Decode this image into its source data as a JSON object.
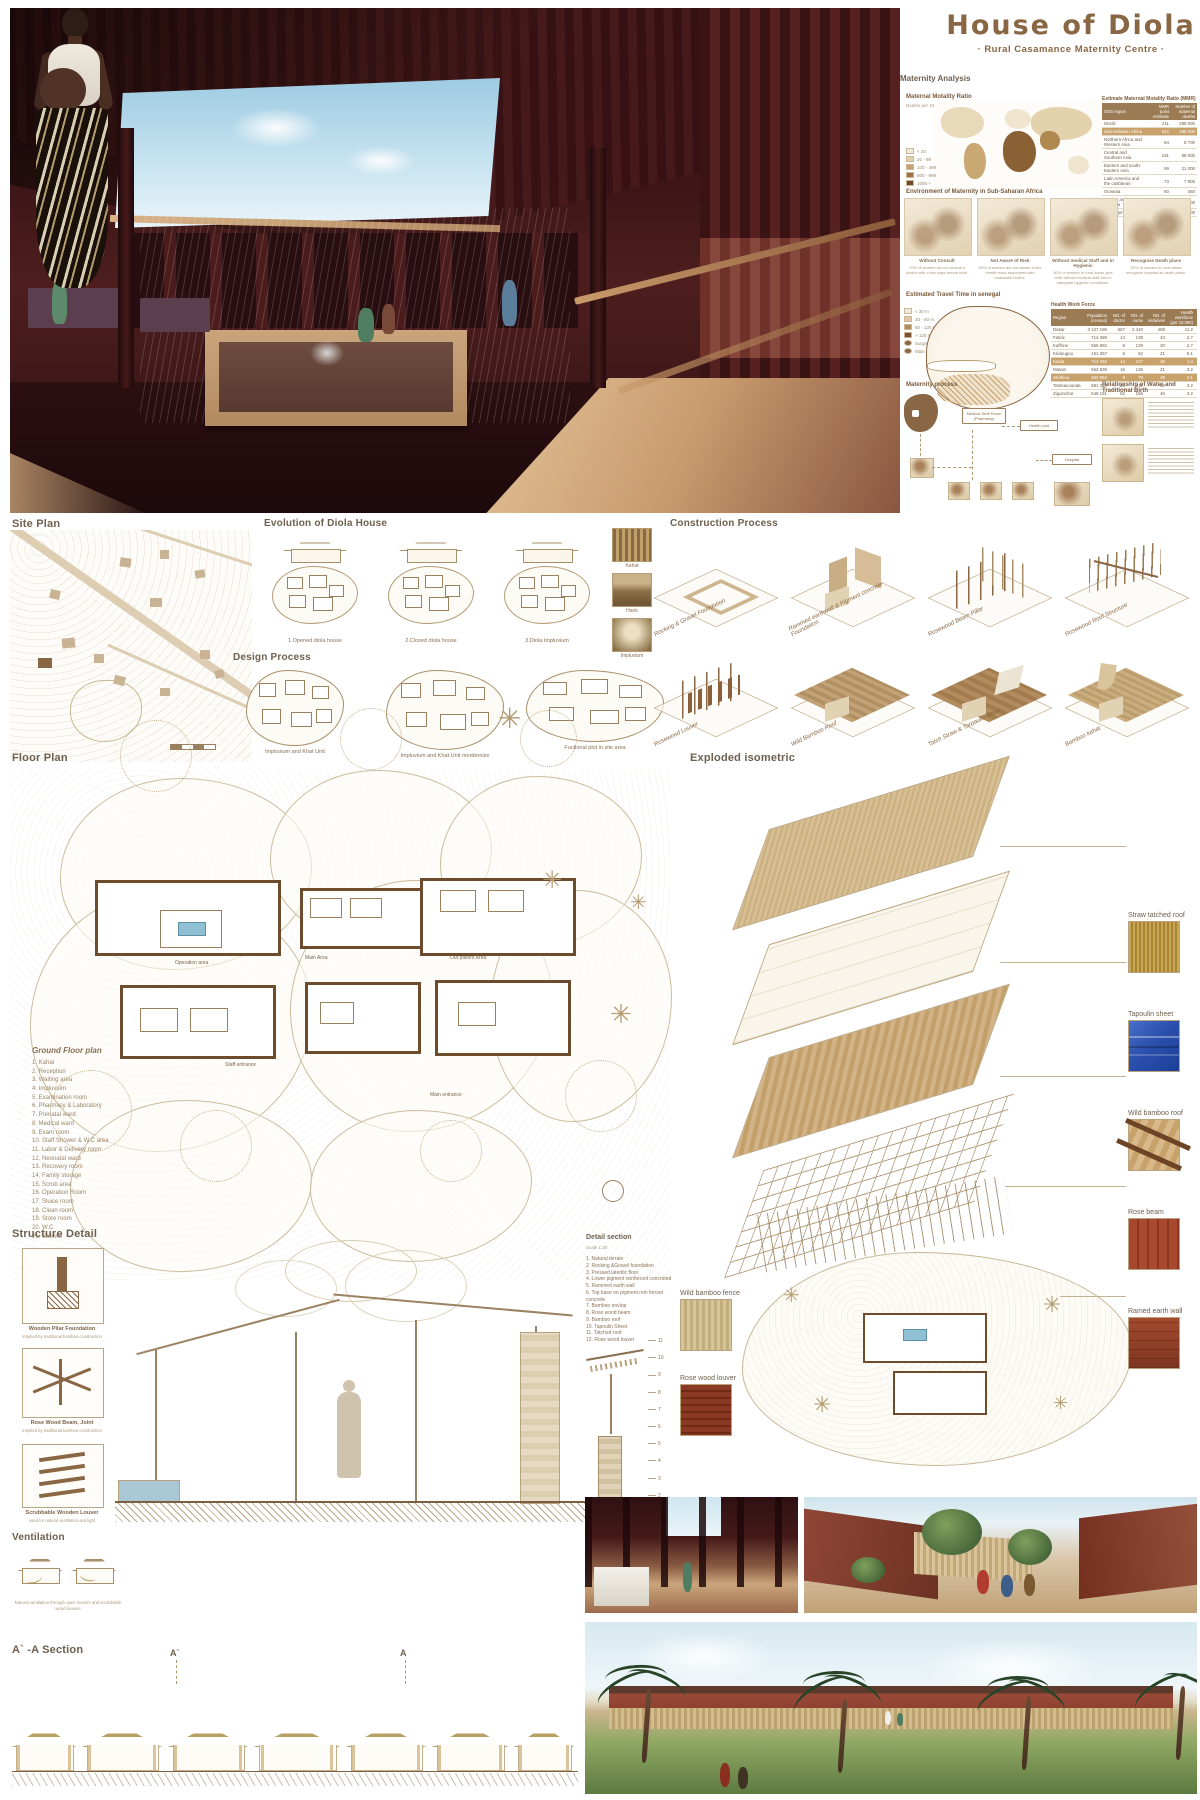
{
  "title": {
    "main": "House of Diola",
    "subtitle": "· Rural Casamance Maternity Centre ·"
  },
  "colors": {
    "accent_brown": "#8a6744",
    "heading_gray": "#6e5f4e",
    "maroon_render": "#4a1c1c",
    "table_header": "#9b7b54",
    "highlight_row": "#c9a26b",
    "tarp_blue": "#2b50ad",
    "sky": "#c9e4f1"
  },
  "maternity": {
    "heading": "Maternity Analysis",
    "mmr_title": "Maternal Motality Ratio",
    "mmr_sub": "Deaths per 100 000 live births",
    "mmr_legend": [
      {
        "label": "< 20",
        "cls": "swc0"
      },
      {
        "label": "20 - 99",
        "cls": "swc1"
      },
      {
        "label": "100 - 499",
        "cls": "swc2"
      },
      {
        "label": "500 - 999",
        "cls": "swc3"
      },
      {
        "label": "1000 +",
        "cls": "swc4"
      }
    ],
    "mmr_table": {
      "title": "Estimate Maternal Motality Ratio (MMR)",
      "col_region": "SDG region",
      "col_mmr": "MMR point estimate",
      "col_deaths": "Number of maternal deaths",
      "rows": [
        {
          "region": "World",
          "mmr": "211",
          "deaths": "295 000"
        },
        {
          "region": "Sub-Saharan Africa",
          "mmr": "542",
          "deaths": "196 000",
          "hl": "hl"
        },
        {
          "region": "Northern Africa and Western Asia",
          "mmr": "84",
          "deaths": "8 700"
        },
        {
          "region": "Central and Southern Asia",
          "mmr": "151",
          "deaths": "58 000"
        },
        {
          "region": "Eastern and south-Eastern Asia",
          "mmr": "69",
          "deaths": "21 000"
        },
        {
          "region": "Latin America and the caribbean",
          "mmr": "73",
          "deaths": "7 800"
        },
        {
          "region": "Oceania",
          "mmr": "60",
          "deaths": "460"
        },
        {
          "region": "Europe and Northern America",
          "mmr": "12",
          "deaths": "1 700"
        },
        {
          "region": "Developing countries",
          "mmr": "232",
          "deaths": "252 000"
        }
      ]
    },
    "environment": {
      "title": "Environment of Maternity in Sub-Saharan Africa",
      "items": [
        {
          "caption": "Without Consult",
          "note": "70% of women do not consult a doctor with a few days before birth."
        },
        {
          "caption": "Not Aware of Risk",
          "note": "30% of women are not aware of the Health risks associated with unassisted births."
        },
        {
          "caption": "Without medical Staff and in Hygienic",
          "note": "60% of women in rural areas give birth without medical staff and in adequate hygienic conditions."
        },
        {
          "caption": "Recognize Death place",
          "note": "20% of women in rural areas recognize hospital as death place."
        }
      ]
    },
    "travel": {
      "title": "Estimated Travel Time in senegal",
      "legend": [
        {
          "label": "< 30 m",
          "cls": "tsw0"
        },
        {
          "label": "30 - 60 m",
          "cls": "tsw1"
        },
        {
          "label": "60 - 120 m",
          "cls": "tsw2"
        },
        {
          "label": "> 120 m",
          "cls": "tsw3"
        }
      ],
      "markers": [
        {
          "label": "Surgery facility"
        },
        {
          "label": "Main road"
        }
      ]
    },
    "workforce": {
      "title": "Health Work Force",
      "cols": {
        "region": "Region",
        "pop": "Population (census)",
        "doc": "NO. of doctor",
        "nurse": "NO. of nurse",
        "mid": "NO. of midwives",
        "hw": "Health workforce (per 10 000)"
      },
      "rows": [
        {
          "region": "Dakar",
          "pop": "3 137 196",
          "doc": "667",
          "nurse": "2 410",
          "mid": "458",
          "hw": "11.2"
        },
        {
          "region": "Fatick",
          "pop": "714 389",
          "doc": "14",
          "nurse": "138",
          "mid": "34",
          "hw": "2.7"
        },
        {
          "region": "Kaffrine",
          "pop": "566 992",
          "doc": "8",
          "nurse": "129",
          "mid": "20",
          "hw": "2.7"
        },
        {
          "region": "Kédougou",
          "pop": "151 357",
          "doc": "6",
          "nurse": "62",
          "mid": "21",
          "hw": "5.1"
        },
        {
          "region": "Kolda",
          "pop": "714 392",
          "doc": "14",
          "nurse": "127",
          "mid": "35",
          "hw": "1.4",
          "hl": "hl"
        },
        {
          "region": "Matam",
          "pop": "562 539",
          "doc": "16",
          "nurse": "136",
          "mid": "21",
          "hw": "3.2"
        },
        {
          "region": "Sédhiou",
          "pop": "452 994",
          "doc": "9",
          "nurse": "79",
          "mid": "28",
          "hw": "2.1",
          "hl": "hl"
        },
        {
          "region": "Tambacounda",
          "pop": "681 310",
          "doc": "25",
          "nurse": "211",
          "mid": "50",
          "hw": "3.2"
        },
        {
          "region": "Ziguinchor",
          "pop": "549 151",
          "doc": "52",
          "nurse": "156",
          "mid": "46",
          "hw": "3.2"
        }
      ]
    },
    "process": {
      "title": "Maternity process",
      "box1": "Medical Stuff Room (Pharmacy)",
      "box2": "Health post",
      "box3": "Hospital"
    },
    "water": {
      "title": "Relationship of Water and  Traditional Birth"
    }
  },
  "site_plan": {
    "title": "Site Plan"
  },
  "evolution": {
    "title": "Evolution of Diola House",
    "stages": [
      {
        "label": "1.Opened diola house"
      },
      {
        "label": "2.Closed diola house"
      },
      {
        "label": "3.Diola Impluvium"
      }
    ],
    "photos": [
      {
        "label": "Kahat",
        "cls": "ph-kahat"
      },
      {
        "label": "Hank",
        "cls": "ph-hank"
      },
      {
        "label": "Impluvium",
        "cls": "ph-impl"
      }
    ]
  },
  "design": {
    "title": "Design Process",
    "stages": [
      {
        "label": "Impluvium and Khat Unit"
      },
      {
        "label": "Impluvium and Khat Unit mordernize"
      },
      {
        "label": "Fuctional plot in site area"
      }
    ]
  },
  "construction": {
    "title": "Construction Process",
    "steps": [
      {
        "label": "Rocking & Gravel Foundation",
        "v": "s1"
      },
      {
        "label": "Rammed earthwall & Pigment concrete Foundation",
        "v": "s2"
      },
      {
        "label": "Rosewood Beam Pillar",
        "v": "s3"
      },
      {
        "label": "Rosewood Roof Structure",
        "v": "s4"
      },
      {
        "label": "Rosewood Louver",
        "v": "s5"
      },
      {
        "label": "Wild Bamboo Roof",
        "v": "s6"
      },
      {
        "label": "Tatch Straw & Tarpaulin sheet",
        "v": "s7"
      },
      {
        "label": "Bamboo kahat",
        "v": "s8"
      }
    ]
  },
  "floor_plan": {
    "title": "Floor Plan",
    "legend_title": "Ground Floor plan",
    "legend": [
      {
        "t": "1. Kahal"
      },
      {
        "t": "2. Reception"
      },
      {
        "t": "3. Waiting area"
      },
      {
        "t": "4. Impluvium"
      },
      {
        "t": "5. Examination room"
      },
      {
        "t": "6. Pharmacy & Laboratory"
      },
      {
        "t": "7. Prenatal ward"
      },
      {
        "t": "8. Medical ward"
      },
      {
        "t": "9. Exam room"
      },
      {
        "t": "10. Staff Shower & W.C area"
      },
      {
        "t": "11. Labor & Delivery room"
      },
      {
        "t": "12. Neonatal ward"
      },
      {
        "t": "13. Recovery room"
      },
      {
        "t": "14. Family storage"
      },
      {
        "t": "15. Scrub area"
      },
      {
        "t": "16. Operation Room"
      },
      {
        "t": "17. Sluice room"
      },
      {
        "t": "18. Clean room"
      },
      {
        "t": "19. Store room"
      },
      {
        "t": "20. W.C"
      },
      {
        "t": "21. Shower"
      }
    ],
    "annotations": [
      {
        "t": "Operation area"
      },
      {
        "t": "Main Area"
      },
      {
        "t": "Out patient Area"
      },
      {
        "t": "Staff entrance"
      },
      {
        "t": "Main entrance"
      }
    ]
  },
  "exploded": {
    "title": "Exploded isometric",
    "right_labels": [
      {
        "label": "Straw tatched roof",
        "cls": "ph-straw"
      },
      {
        "label": "Tapoulin sheet",
        "cls": "ph-tarp"
      },
      {
        "label": "Wild bamboo roof",
        "cls": "ph-bamboo"
      },
      {
        "label": "Rose beam",
        "cls": "ph-rose"
      },
      {
        "label": "Ramed earth wall",
        "cls": "ph-earth"
      }
    ],
    "left_labels": [
      {
        "label": "Wild bamboo fence",
        "cls": "ph-fence"
      },
      {
        "label": "Rose wood louver",
        "cls": "ph-louver"
      }
    ]
  },
  "structure": {
    "title": "Structure Detail",
    "items": [
      {
        "caption": "Wooden Pilar Foundation",
        "note": "Inspried by traditional bamboo construction"
      },
      {
        "caption": "Rose Wood Beam, Joint",
        "note": "Inspried by traditional bamboo construction"
      },
      {
        "caption": "Scrubbable Wooden Louver",
        "note": "used for natural ventilation and light"
      }
    ]
  },
  "detail_section": {
    "title": "Detail section",
    "scale": "Scale 1:30",
    "items": [
      {
        "t": "1. Natural terrain"
      },
      {
        "t": "2. Rocking &Gravel foundation"
      },
      {
        "t": "3. Pressed lateritic floor"
      },
      {
        "t": "4. Lower pigment reinforced concreted"
      },
      {
        "t": "5. Rammed earth wall"
      },
      {
        "t": "6. Top base on pigment rein forced concrete"
      },
      {
        "t": "7. Bamboo envlop"
      },
      {
        "t": "8. Rose wood beam"
      },
      {
        "t": "9. Bamboo roof"
      },
      {
        "t": "10. Tapoulin Sheet"
      },
      {
        "t": "11. Tatched roof"
      },
      {
        "t": "12. Rose wood louver"
      }
    ],
    "callouts": [
      {
        "n": "11"
      },
      {
        "n": "10"
      },
      {
        "n": "9"
      },
      {
        "n": "8"
      },
      {
        "n": "7"
      },
      {
        "n": "6"
      },
      {
        "n": "5"
      },
      {
        "n": "4"
      },
      {
        "n": "3"
      },
      {
        "n": "2"
      },
      {
        "n": "1"
      }
    ]
  },
  "ventilation": {
    "title": "Ventilation",
    "note": "Natural ventilation through open louvers and scrubbable wood louvers"
  },
  "aa_section": {
    "title": "A` -A  Section",
    "mark_a1": "A`",
    "mark_a": "A"
  }
}
